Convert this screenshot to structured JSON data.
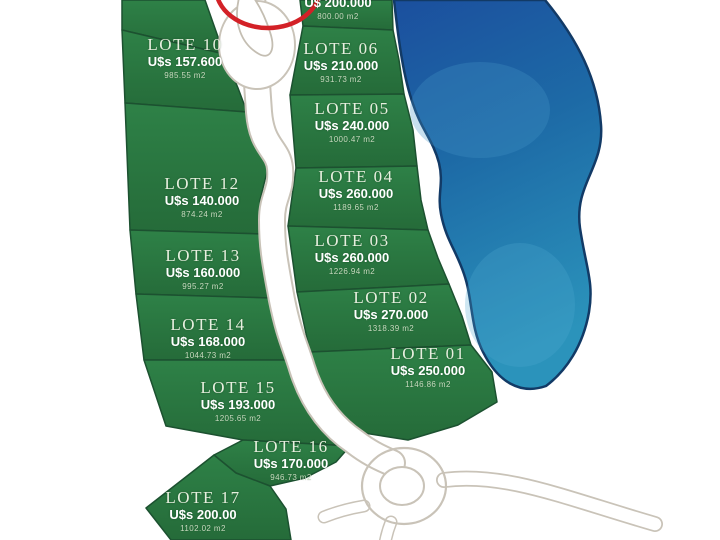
{
  "lots": {
    "left": [
      {
        "name": "LOTE 10",
        "price": "U$s 157.600",
        "area": "985.55 m2"
      },
      {
        "name": "LOTE 12",
        "price": "U$s 140.000",
        "area": "874.24 m2"
      },
      {
        "name": "LOTE 13",
        "price": "U$s 160.000",
        "area": "995.27 m2"
      },
      {
        "name": "LOTE 14",
        "price": "U$s 168.000",
        "area": "1044.73 m2"
      },
      {
        "name": "LOTE 15",
        "price": "U$s 193.000",
        "area": "1205.65 m2"
      },
      {
        "name": "LOTE 16",
        "price": "U$s 170.000",
        "area": "946.73 m2"
      },
      {
        "name": "LOTE 17",
        "price": "U$s 200.00",
        "area": "1102.02 m2"
      }
    ],
    "right": [
      {
        "name": "LOTE 06",
        "price": "U$s 210.000",
        "area": "931.73 m2"
      },
      {
        "name": "LOTE 05",
        "price": "U$s 240.000",
        "area": "1000.47 m2"
      },
      {
        "name": "LOTE 04",
        "price": "U$s 260.000",
        "area": "1189.65 m2"
      },
      {
        "name": "LOTE 03",
        "price": "U$s 260.000",
        "area": "1226.94 m2"
      },
      {
        "name": "LOTE 02",
        "price": "U$s 270.000",
        "area": "1318.39 m2"
      },
      {
        "name": "LOTE 01",
        "price": "U$s 250.000",
        "area": "1146.86 m2"
      }
    ],
    "top_partial": {
      "price": "U$ 200.000",
      "area": "800.00 m2"
    }
  },
  "colors": {
    "lot_green": "#2b7a40",
    "lot_border": "#1c5130",
    "lake_top": "#1b4f9e",
    "lake_bottom": "#2b93bb",
    "road_edge": "#c9c3b8",
    "annotation_red": "#d32127",
    "label_text": "#ffffff"
  }
}
